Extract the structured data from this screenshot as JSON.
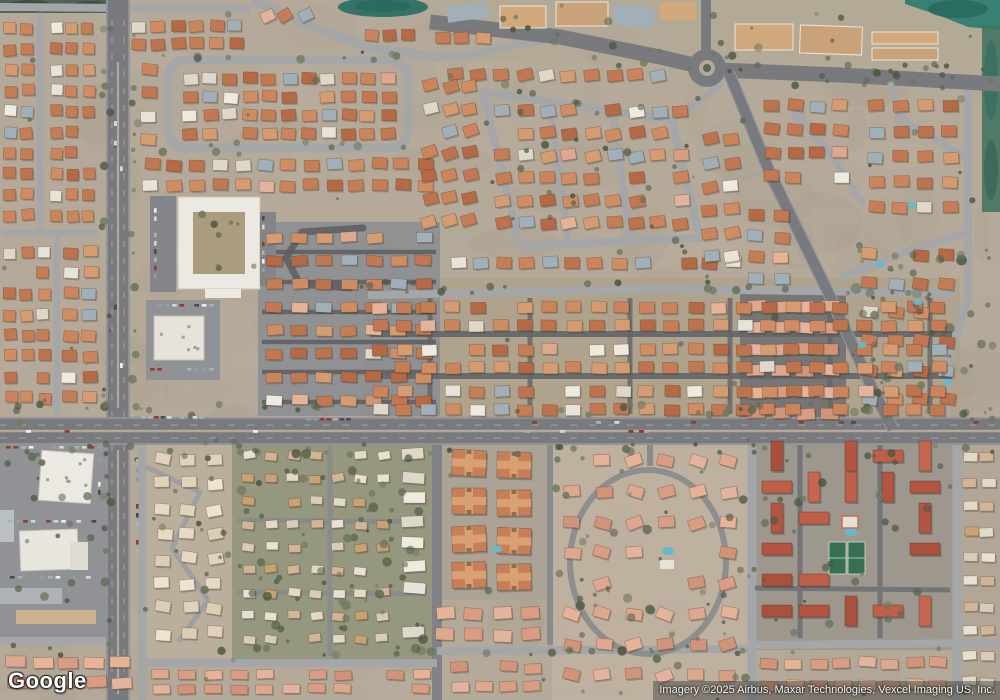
{
  "map": {
    "provider": "Google",
    "view_type": "satellite",
    "scene": "aerial-suburban-neighborhood"
  },
  "logo": {
    "text": "Google"
  },
  "attribution": {
    "text": "Imagery ©2025 Airbus, Maxar Technologies, Vexcel Imaging US, Inc."
  },
  "colors": {
    "base": "#b4a998",
    "haze": "#cfc8bb",
    "asphalt": "#73767a",
    "asphalt_edge": "#8e9195",
    "street": "#a3a5a6",
    "alley": "#5d6064",
    "drive": "#85888b",
    "median": "#b3a897",
    "parking": "#8d9093",
    "parking_dark": "#7f8285",
    "lane_dash": "#e8e8e8",
    "roof_orange": [
      "#c1744c",
      "#cb8156",
      "#b4663f",
      "#d08b5e",
      "#c47a50",
      "#d49a6c",
      "#bc6f47"
    ],
    "roof_gray": "#9fafb8",
    "roof_white": [
      "#e9e5da",
      "#dfdacb",
      "#f0ece1"
    ],
    "roof_salmon": [
      "#dfa78c",
      "#d89b80",
      "#e7b394",
      "#d19176",
      "#e3b49b"
    ],
    "roof_red": [
      "#b2503a",
      "#bf5a41",
      "#a84b36",
      "#c4614a"
    ],
    "roof_cream": [
      "#e8dcc6",
      "#e2d4bb",
      "#eee5d2",
      "#dccfb4"
    ],
    "roof_mixed": [
      "#d8cdb9",
      "#e4dbc8",
      "#c9a06f",
      "#d2b494",
      "#e8e2d4"
    ],
    "building_white": "#ecebe3",
    "courtyard": "#a89a7c",
    "ground_mid": "#aca189",
    "ground_green": "#8f9478",
    "ground_dark": "#6a6d70",
    "ground_concrete": "#8a8d90",
    "ground_pink": "#bfb0a0",
    "ground_red_complex": "#9b958b",
    "tree_dark": "#44523a",
    "tree_mid": "#55644a",
    "tree_light": "#68765a",
    "water_teal": "#2f7d6f",
    "water_dark": "#1f6358",
    "pool_blue": "#5fb9cf",
    "tennis_green": "#2f6b4e",
    "shadow": "#2f2a22"
  }
}
